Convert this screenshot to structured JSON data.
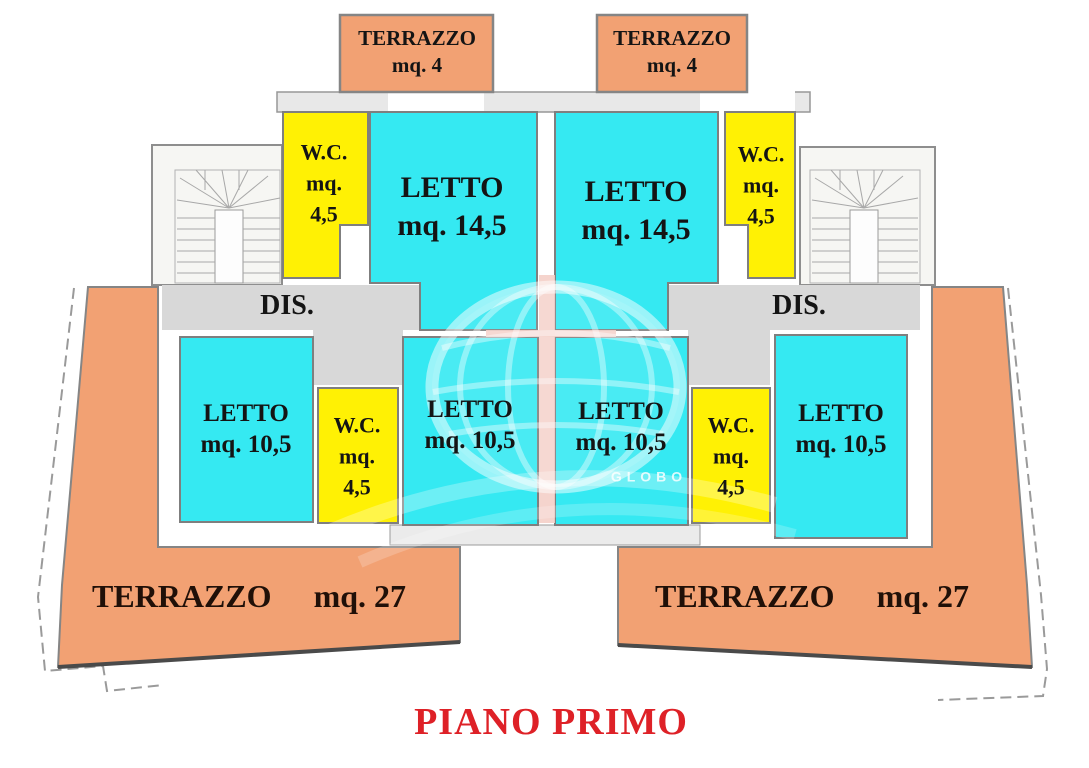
{
  "plan": {
    "title": "PIANO PRIMO",
    "floor_label_color": "#DE2127",
    "watermark": {
      "brand": "GLOBO"
    },
    "colors": {
      "terrace": "#F2A173",
      "bedroom": "#35E9F2",
      "wc": "#FFF104",
      "corridor": "#D8D8D8",
      "walls": "#8E8E8E",
      "title": "#DE2127"
    },
    "rooms": {
      "terraceTopLeft": {
        "name": "TERRAZZO",
        "area": "mq. 4"
      },
      "terraceTopRight": {
        "name": "TERRAZZO",
        "area": "mq. 4"
      },
      "wcUpperLeft": {
        "name": "W.C.",
        "unit": "mq.",
        "area": "4,5"
      },
      "wcUpperRight": {
        "name": "W.C.",
        "unit": "mq.",
        "area": "4,5"
      },
      "bedroomLargeLeft": {
        "name": "LETTO",
        "area": "mq. 14,5"
      },
      "bedroomLargeRight": {
        "name": "LETTO",
        "area": "mq. 14,5"
      },
      "hallLeft": {
        "name": "DIS."
      },
      "hallRight": {
        "name": "DIS."
      },
      "bedroomFarLeft": {
        "name": "LETTO",
        "area": "mq. 10,5"
      },
      "bedroomCenterLeft": {
        "name": "LETTO",
        "area": "mq. 10,5"
      },
      "bedroomCenterRight": {
        "name": "LETTO",
        "area": "mq. 10,5"
      },
      "bedroomFarRight": {
        "name": "LETTO",
        "area": "mq. 10,5"
      },
      "wcLowerLeft": {
        "name": "W.C.",
        "unit": "mq.",
        "area": "4,5"
      },
      "wcLowerRight": {
        "name": "W.C.",
        "unit": "mq.",
        "area": "4,5"
      },
      "terraceBottomLeft": {
        "name": "TERRAZZO",
        "area": "mq. 27"
      },
      "terraceBottomRight": {
        "name": "TERRAZZO",
        "area": "mq. 27"
      }
    }
  }
}
